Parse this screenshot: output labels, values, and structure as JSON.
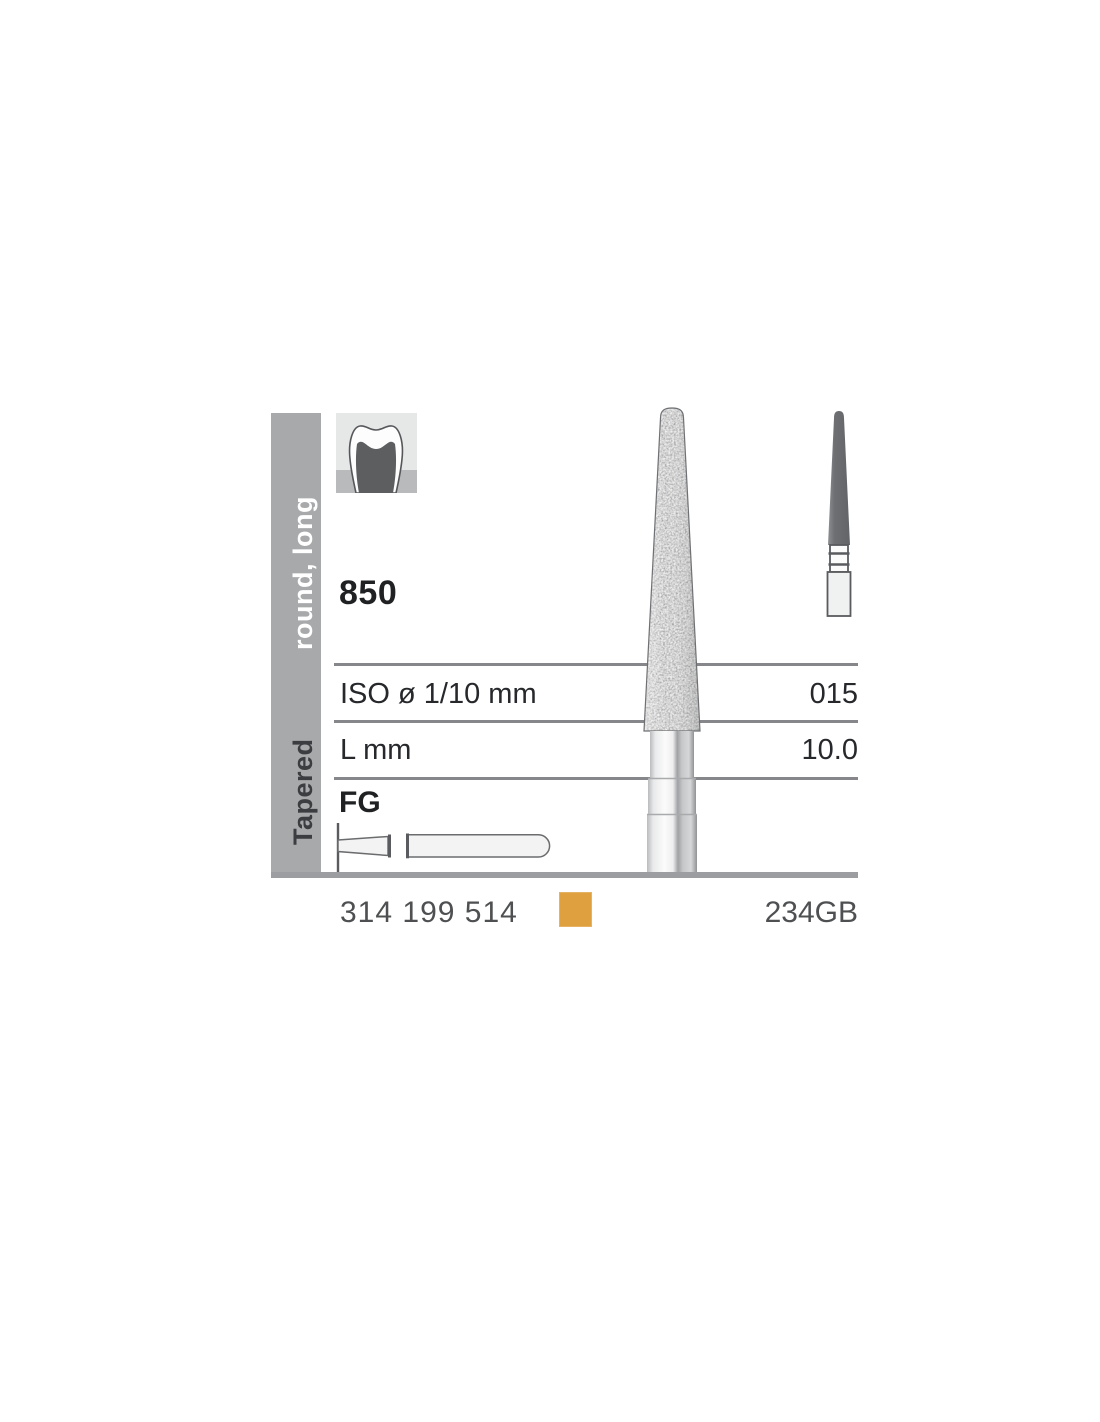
{
  "sidebar": {
    "group": "Tapered",
    "shape": "round, long"
  },
  "product": {
    "figure": "850",
    "shank_type": "FG"
  },
  "table": {
    "rows": [
      {
        "label": "ISO ø 1/10 mm",
        "value": "015"
      },
      {
        "label": "L mm",
        "value": "10.0"
      }
    ]
  },
  "footer": {
    "order_number": "314 199 514",
    "product_code": "234GB"
  },
  "icons": {
    "tooth": "tooth-crown-icon",
    "large_bur": "diamond-bur-photo",
    "small_bur": "bur-silhouette",
    "fg_shank": "fg-shank-outline-icon"
  },
  "colors": {
    "sidebar_gray": "#a7a9ab",
    "grit_swatch_orange": "#dfa140",
    "rule_gray": "#85878a",
    "thick_rule_gray": "#9b9da0"
  }
}
